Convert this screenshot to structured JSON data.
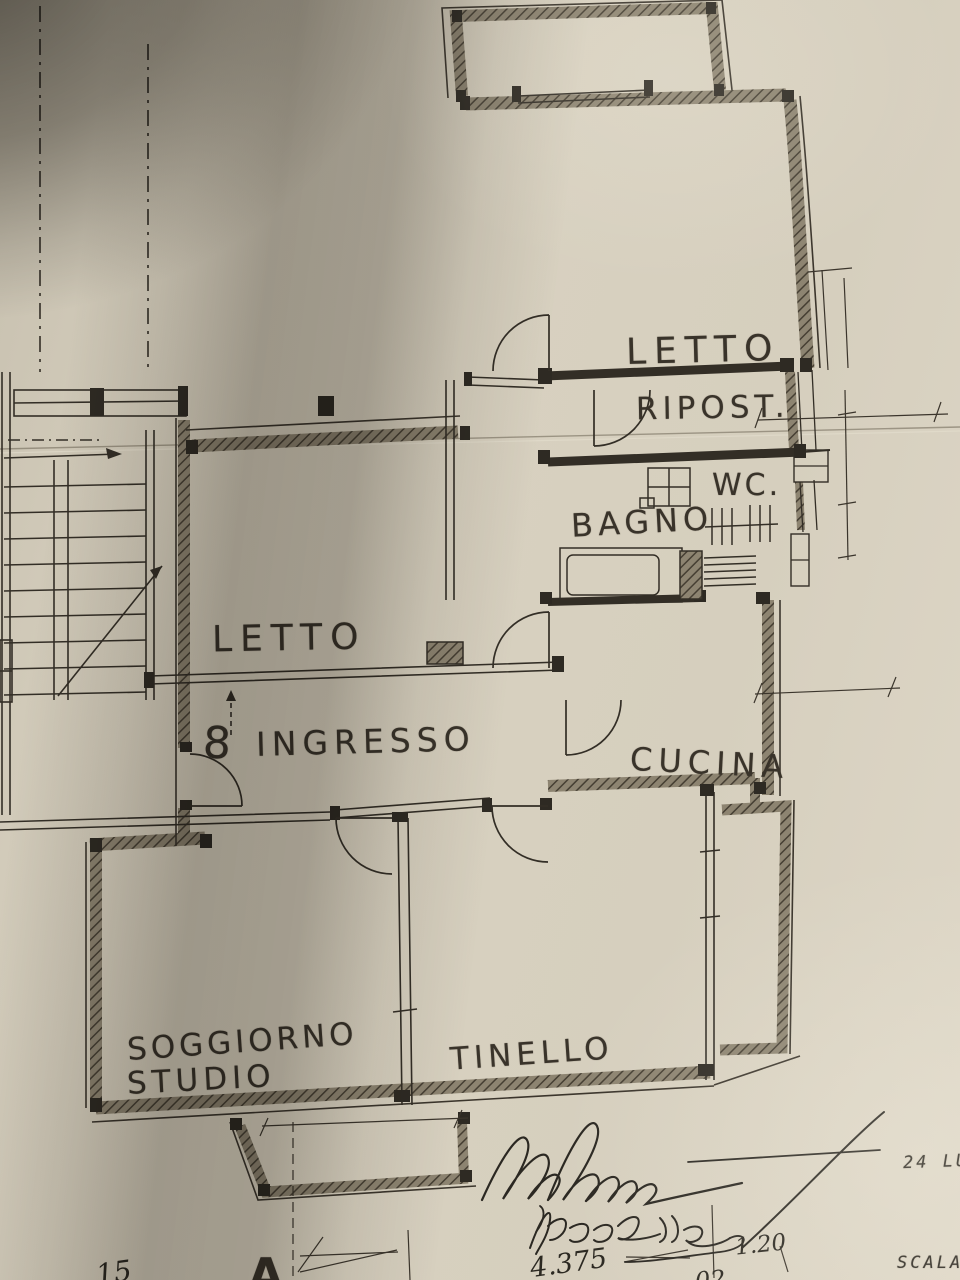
{
  "plan": {
    "rooms": [
      {
        "id": "letto_top",
        "label": "LETTO"
      },
      {
        "id": "ripostiglio",
        "label": "RIPOST."
      },
      {
        "id": "wc",
        "label": "WC."
      },
      {
        "id": "bagno",
        "label": "BAGNO"
      },
      {
        "id": "letto_left",
        "label": "LETTO"
      },
      {
        "id": "ingresso",
        "label": "INGRESSO"
      },
      {
        "id": "cucina",
        "label": "CUCINA"
      },
      {
        "id": "soggiorno_line1",
        "label": "SOGGIORNO"
      },
      {
        "id": "soggiorno_line2",
        "label": "STUDIO"
      },
      {
        "id": "tinello",
        "label": "TINELLO"
      }
    ],
    "unit_number": "8",
    "section_letter": "A"
  },
  "annotations": {
    "stamp_date_partial": "24 LU",
    "stamp_scale_partial": "SCALA",
    "handwritten_name": "Piccolle",
    "dimension_main": "4.375",
    "dimension_small": "1.20",
    "dimension_partial_bottom": "02",
    "dimension_partial_left": "15"
  },
  "colors": {
    "paper": "#d8d1c0",
    "ink": "#332e26",
    "wall_hatch": "#8d8471",
    "shadow": "#3c372e"
  }
}
